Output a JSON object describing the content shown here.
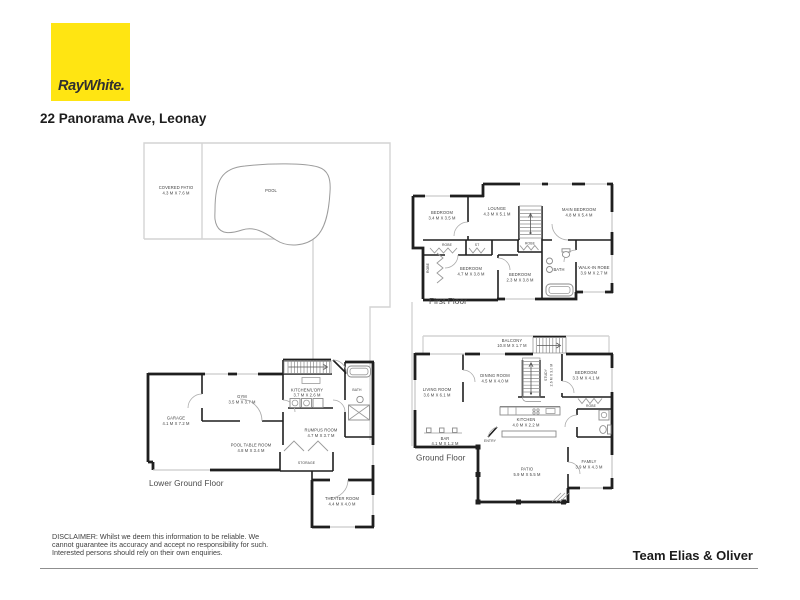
{
  "header": {
    "logo_text": "RayWhite.",
    "address": "22 Panorama Ave, Leonay"
  },
  "yard": {
    "covered_patio": {
      "name": "COVERED PATIO",
      "dims": "4.3 M X 7.6 M"
    },
    "pool": {
      "name": "POOL"
    }
  },
  "floors": {
    "first": {
      "label": "First Floor",
      "rooms": {
        "bedroom_top": {
          "name": "BEDROOM",
          "dims": "3.4 M X 3.5 M"
        },
        "lounge": {
          "name": "LOUNGE",
          "dims": "4.3 M X 5.1 M"
        },
        "main_bedroom": {
          "name": "MAIN BEDROOM",
          "dims": "4.8 M X 5.4 M"
        },
        "robe_a": {
          "name": "ROBE"
        },
        "store": {
          "name": "ST"
        },
        "robe_side": {
          "name": "ROBE"
        },
        "bedroom_mid": {
          "name": "BEDROOM",
          "dims": "4.7 M X 3.8 M"
        },
        "robe_b": {
          "name": "ROBE"
        },
        "bedroom_small": {
          "name": "BEDROOM",
          "dims": "2.3 M X 3.8 M"
        },
        "bath": {
          "name": "BATH"
        },
        "walk_in_robe": {
          "name": "WALK-IN ROBE",
          "dims": "3.9 M X 2.7 M"
        }
      }
    },
    "ground": {
      "label": "Ground Floor",
      "rooms": {
        "balcony": {
          "name": "BALCONY",
          "dims": "10.8 M X 1.7 M"
        },
        "living": {
          "name": "LIVING ROOM",
          "dims": "3.6 M X 6.1 M"
        },
        "dining": {
          "name": "DINING ROOM",
          "dims": "4.5 M X 4.0 M"
        },
        "study": {
          "name": "STUDY",
          "dims": "2.6 M X 3.0 M"
        },
        "bedroom": {
          "name": "BEDROOM",
          "dims": "3.3 M X 4.1 M"
        },
        "robe": {
          "name": "ROBE"
        },
        "kitchen": {
          "name": "KITCHEN",
          "dims": "4.0 M X 2.2 M"
        },
        "bar": {
          "name": "BAR",
          "dims": "4.1 M X 1.2 M"
        },
        "entry": {
          "name": "ENTRY"
        },
        "patio": {
          "name": "PATIO",
          "dims": "5.9 M X 5.5 M"
        },
        "family": {
          "name": "FAMILY",
          "dims": "3.9 M X 4.3 M"
        }
      }
    },
    "lower": {
      "label": "Lower Ground Floor",
      "rooms": {
        "garage": {
          "name": "GARAGE",
          "dims": "4.1 M X 7.2 M"
        },
        "gym": {
          "name": "GYM",
          "dims": "3.5 M X 3.7 M"
        },
        "kitchen_laundry": {
          "name": "KITCHEN/L'DRY",
          "dims": "3.7 M X 2.6 M"
        },
        "bath": {
          "name": "BATH"
        },
        "rumpus": {
          "name": "RUMPUS ROOM",
          "dims": "4.7 M X 3.7 M"
        },
        "pool_table": {
          "name": "POOL TABLE ROOM",
          "dims": "4.8 M X 3.4 M"
        },
        "storage": {
          "name": "STORAGE"
        },
        "theater": {
          "name": "THEATER ROOM",
          "dims": "4.4 M X 4.0 M"
        }
      }
    }
  },
  "footer": {
    "disclaimer_lines": [
      "DISCLAIMER: Whilst we deem this information to be reliable. We",
      "cannot guarantee its accuracy and accept no responsibility for such.",
      "Interested persons should rely on their own enquiries."
    ],
    "team": "Team Elias & Oliver"
  },
  "colors": {
    "brand": "#ffe512",
    "walls": "#1f1f1f",
    "light_lines": "#d4d4d4"
  }
}
